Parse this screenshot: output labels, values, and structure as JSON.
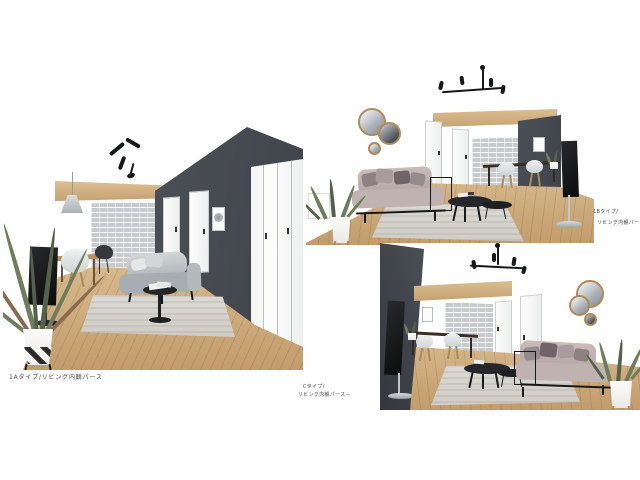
{
  "captions": {
    "a": {
      "caption": "1Aタイプ/リビング内観パース"
    },
    "b": {
      "line1": "1Bタイプ/",
      "line2": "リビング内観パース"
    },
    "c": {
      "line1": "Cタイプ/",
      "line2": "リビング内観パース—"
    }
  },
  "renders": [
    {
      "id": "render-1a",
      "type_label": "1Aタイプ",
      "view_label": "リビング内観パース"
    },
    {
      "id": "render-1b",
      "type_label": "1Bタイプ",
      "view_label": "リビング内観パース"
    },
    {
      "id": "render-c",
      "type_label": "Cタイプ",
      "view_label": "リビング内観パース"
    }
  ],
  "palette": {
    "page-bg": "#ffffff",
    "wall-dark": "#3f434a",
    "wood-beam": "#c6a171",
    "wood-floor": "#c29c6c",
    "brick": "#c7cbce",
    "sofa-gray": "#b0b5b9",
    "sofa-mauve": "#c0b2b1",
    "cushion-dark": "#6f6468",
    "rug": "#dbd9d4",
    "metal-black": "#1a1b1d",
    "metal-silver": "#c3c6c9",
    "mirror-gold": "#b28a58",
    "plant-green": "#6f7d5c",
    "caption": "#4a4a4a"
  }
}
